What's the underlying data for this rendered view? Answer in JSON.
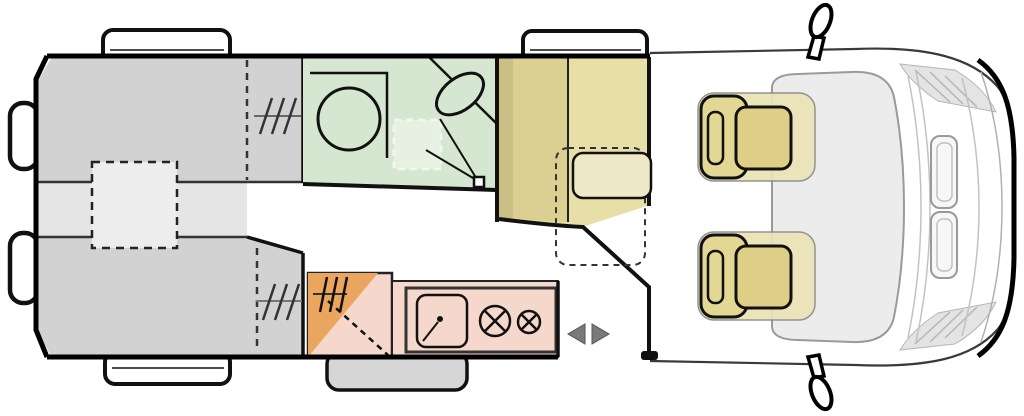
{
  "title": "Campervan top-view floor plan",
  "diagram": {
    "type": "motorhome-floorplan",
    "orientation": "cab-on-right, rear-doors-on-left",
    "areas": [
      {
        "id": "rear-bed-top",
        "label": "rear single bed (upper)"
      },
      {
        "id": "rear-bed-bottom",
        "label": "rear single bed (lower)"
      },
      {
        "id": "bed-infill",
        "label": "removable infill cushion (dashed)"
      },
      {
        "id": "wardrobe-top",
        "label": "wardrobe hanging-rail symbol"
      },
      {
        "id": "wardrobe-bottom",
        "label": "wardrobe hanging-rail symbol"
      },
      {
        "id": "bathroom",
        "label": "washroom with shower, corner basin, roof vent, folding door"
      },
      {
        "id": "dinette-seat",
        "label": "forward-facing travel bench with table"
      },
      {
        "id": "kitchen",
        "label": "kitchen block with sink and two-burner hob"
      },
      {
        "id": "corner-cabinet",
        "label": "corner cabinet / wardrobe (orange)"
      },
      {
        "id": "entry-door",
        "label": "sliding entry door (arrows)"
      },
      {
        "id": "cab",
        "label": "driver cab with two swivel seats"
      }
    ]
  },
  "colors": {
    "bed_gray": "#d2d2d2",
    "bed_mid": "#e5e5e5",
    "infill": "#ededed",
    "bathroom_green": "#d5e7d0",
    "skylight": "#e7f1e2",
    "seat_tan": "#e8dfa8",
    "seat_back_tan": "#dbcf92",
    "wall_strip_tan": "#cbbf85",
    "table_cream": "#f0e9c8",
    "kitchen_pink": "#f6d7cb",
    "cabinet_orange": "#eaa55e",
    "cab_seat_cushion": "#dfce86",
    "cab_seat_back": "#e3d794",
    "cab_seat_halo": "#ebe3b5",
    "windshield_gray": "#ececec",
    "bump_gray": "#d6d6d6",
    "hatch_panel": "#e4e4e4",
    "outline_black": "#111111",
    "arrow_gray": "#7a7a7a",
    "white": "#ffffff"
  }
}
